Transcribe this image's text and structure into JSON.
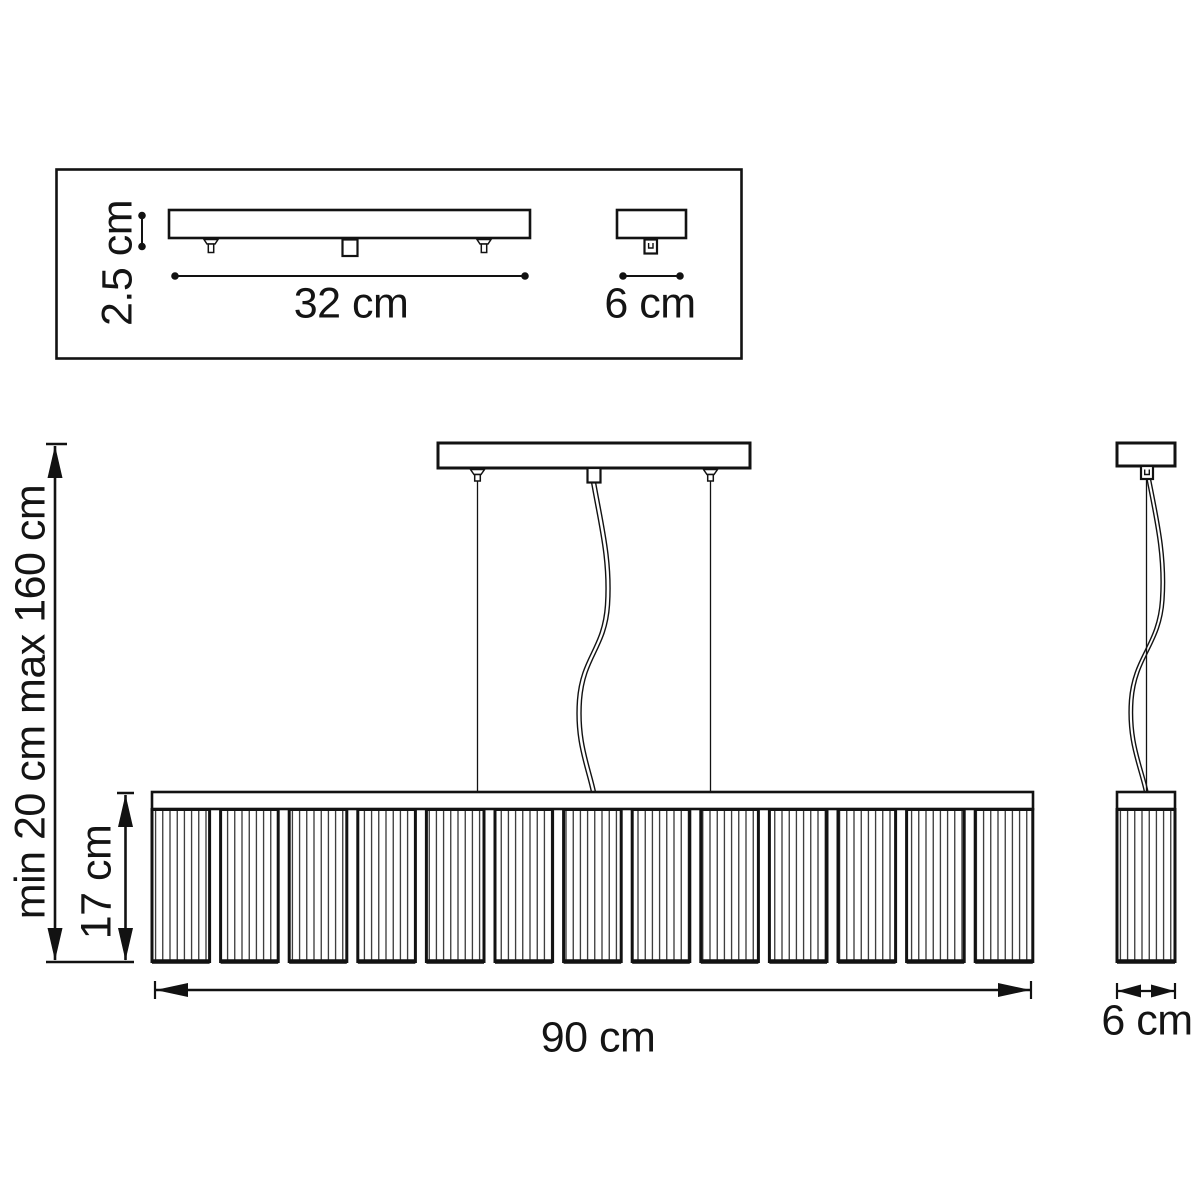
{
  "colors": {
    "background": "#ffffff",
    "line": "#121212"
  },
  "views": {
    "mount": {
      "height_label": "2.5 cm",
      "length_label": "32 cm",
      "end_width_label": "6 cm"
    },
    "front": {
      "suspension_range_label": "min 20 cm max 160 cm",
      "shade_height_label": "17 cm",
      "width_label": "90 cm"
    },
    "side": {
      "width_label": "6 cm"
    }
  }
}
